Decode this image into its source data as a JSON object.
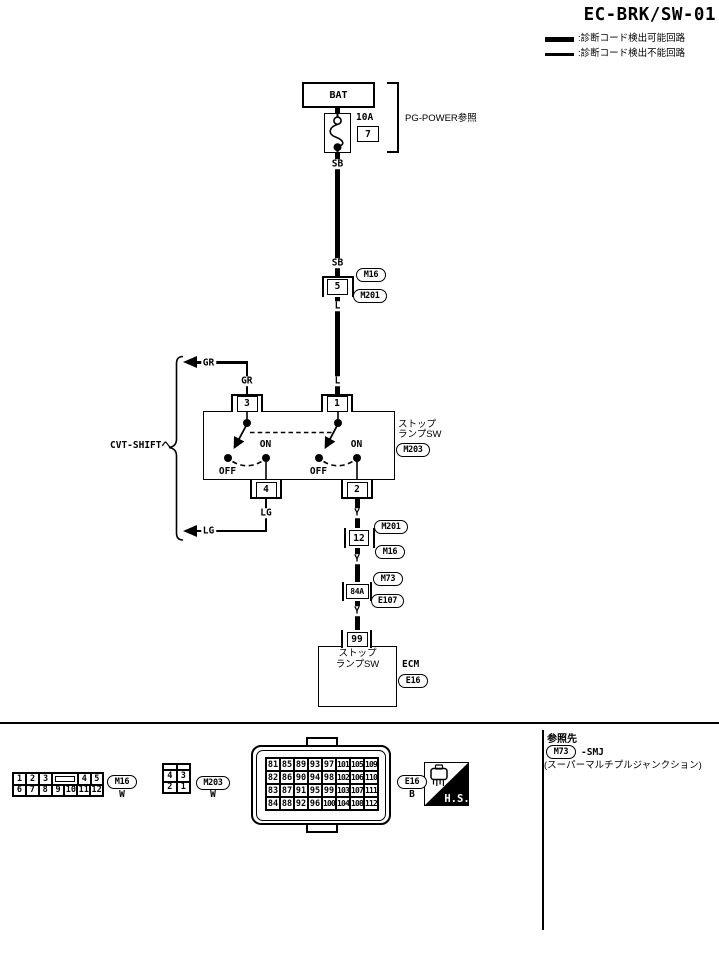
{
  "title": "EC-BRK/SW-01",
  "legend": {
    "detectable": ":診断コード検出可能回路",
    "undetectable": ":診断コード検出不能回路"
  },
  "power": {
    "bat": "BAT",
    "fuse_rating": "10A",
    "fuse_number": "7",
    "ref": "PG-POWER参照"
  },
  "wires": {
    "sb1": "SB",
    "sb2": "SB",
    "l1": "L",
    "l2": "L",
    "gr_arrow": "GR",
    "gr_pin": "GR",
    "lg_pin": "LG",
    "lg_arrow": "LG",
    "y1": "Y",
    "y2": "Y",
    "y3": "Y"
  },
  "branch": {
    "cvt": "CVT-SHIFTへ"
  },
  "connectors": {
    "c5": {
      "pin": "5",
      "top": "M16",
      "bottom": "M201"
    },
    "c12": {
      "pin": "12",
      "top": "M201",
      "bottom": "M16"
    },
    "c84a": {
      "pin": "84A",
      "top": "M73",
      "bottom": "E107"
    }
  },
  "stop_switch": {
    "pins": {
      "p3": "3",
      "p1": "1",
      "p4": "4",
      "p2": "2"
    },
    "on_label": "ON",
    "off_label": "OFF",
    "name_line1": "ストップ",
    "name_line2": "ランプSW",
    "connector": "M203"
  },
  "ecm": {
    "pin": "99",
    "line1": "ストップ",
    "line2": "ランプSW",
    "name": "ECM",
    "connector": "E16"
  },
  "footer": {
    "m16": {
      "label": "M16",
      "color": "W",
      "row1": [
        "1",
        "2",
        "3",
        "4",
        "5"
      ],
      "row2": [
        "6",
        "7",
        "8",
        "9",
        "10",
        "11",
        "12"
      ]
    },
    "m203": {
      "label": "M203",
      "color": "W",
      "row1": [
        "4",
        "3"
      ],
      "row2": [
        "2",
        "1"
      ]
    },
    "e16": {
      "label": "E16",
      "color": "B",
      "rows": [
        [
          "81",
          "85",
          "89",
          "93",
          "97",
          "101",
          "105",
          "109"
        ],
        [
          "82",
          "86",
          "90",
          "94",
          "98",
          "102",
          "106",
          "110"
        ],
        [
          "83",
          "87",
          "91",
          "95",
          "99",
          "103",
          "107",
          "111"
        ],
        [
          "84",
          "88",
          "92",
          "96",
          "100",
          "104",
          "108",
          "112"
        ]
      ]
    },
    "hs": "H.S.",
    "ref_panel": {
      "heading": "参照先",
      "connector": "M73",
      "suffix": "-SMJ",
      "note": "(スーパーマルチプルジャンクション)"
    }
  }
}
